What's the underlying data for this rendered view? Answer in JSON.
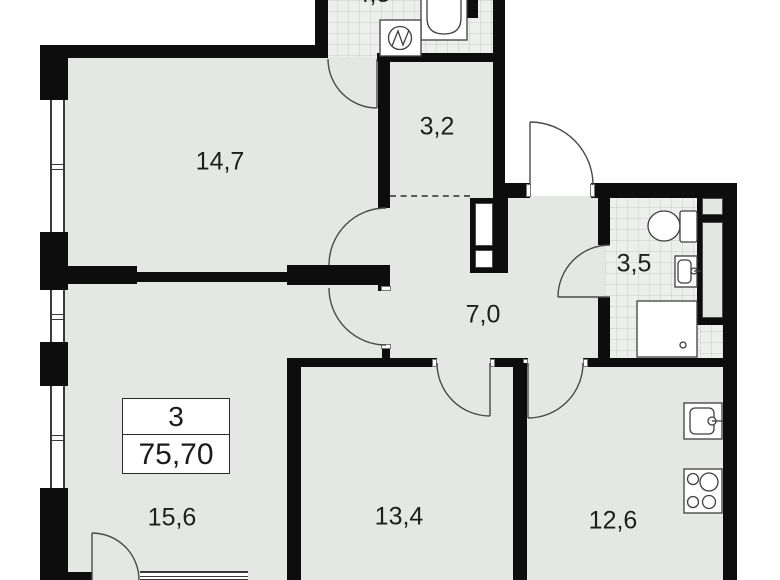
{
  "plan": {
    "type": "apartment-floor-plan",
    "info_box": {
      "rooms_count": "3",
      "total_area": "75,70"
    },
    "rooms": [
      {
        "name": "room-14-7",
        "area": "14,7"
      },
      {
        "name": "room-3-2",
        "area": "3,2"
      },
      {
        "name": "hallway-7-0",
        "area": "7,0"
      },
      {
        "name": "bathroom-3-5",
        "area": "3,5"
      },
      {
        "name": "room-15-6",
        "area": "15,6"
      },
      {
        "name": "room-13-4",
        "area": "13,4"
      },
      {
        "name": "kitchen-12-6",
        "area": "12,6"
      },
      {
        "name": "top-bathroom",
        "area": "4,5"
      }
    ],
    "fixtures": [
      "bathtub",
      "washing-machine",
      "toilet",
      "wash-basin",
      "shower-tray",
      "kitchen-sink",
      "stove",
      "ventilation-shaft"
    ],
    "colors": {
      "wall": "#0d0d0d",
      "floor": "#e4e7e4",
      "tile_floor": "#edefed",
      "background": "#ffffff",
      "line": "#4a4a4a"
    }
  }
}
